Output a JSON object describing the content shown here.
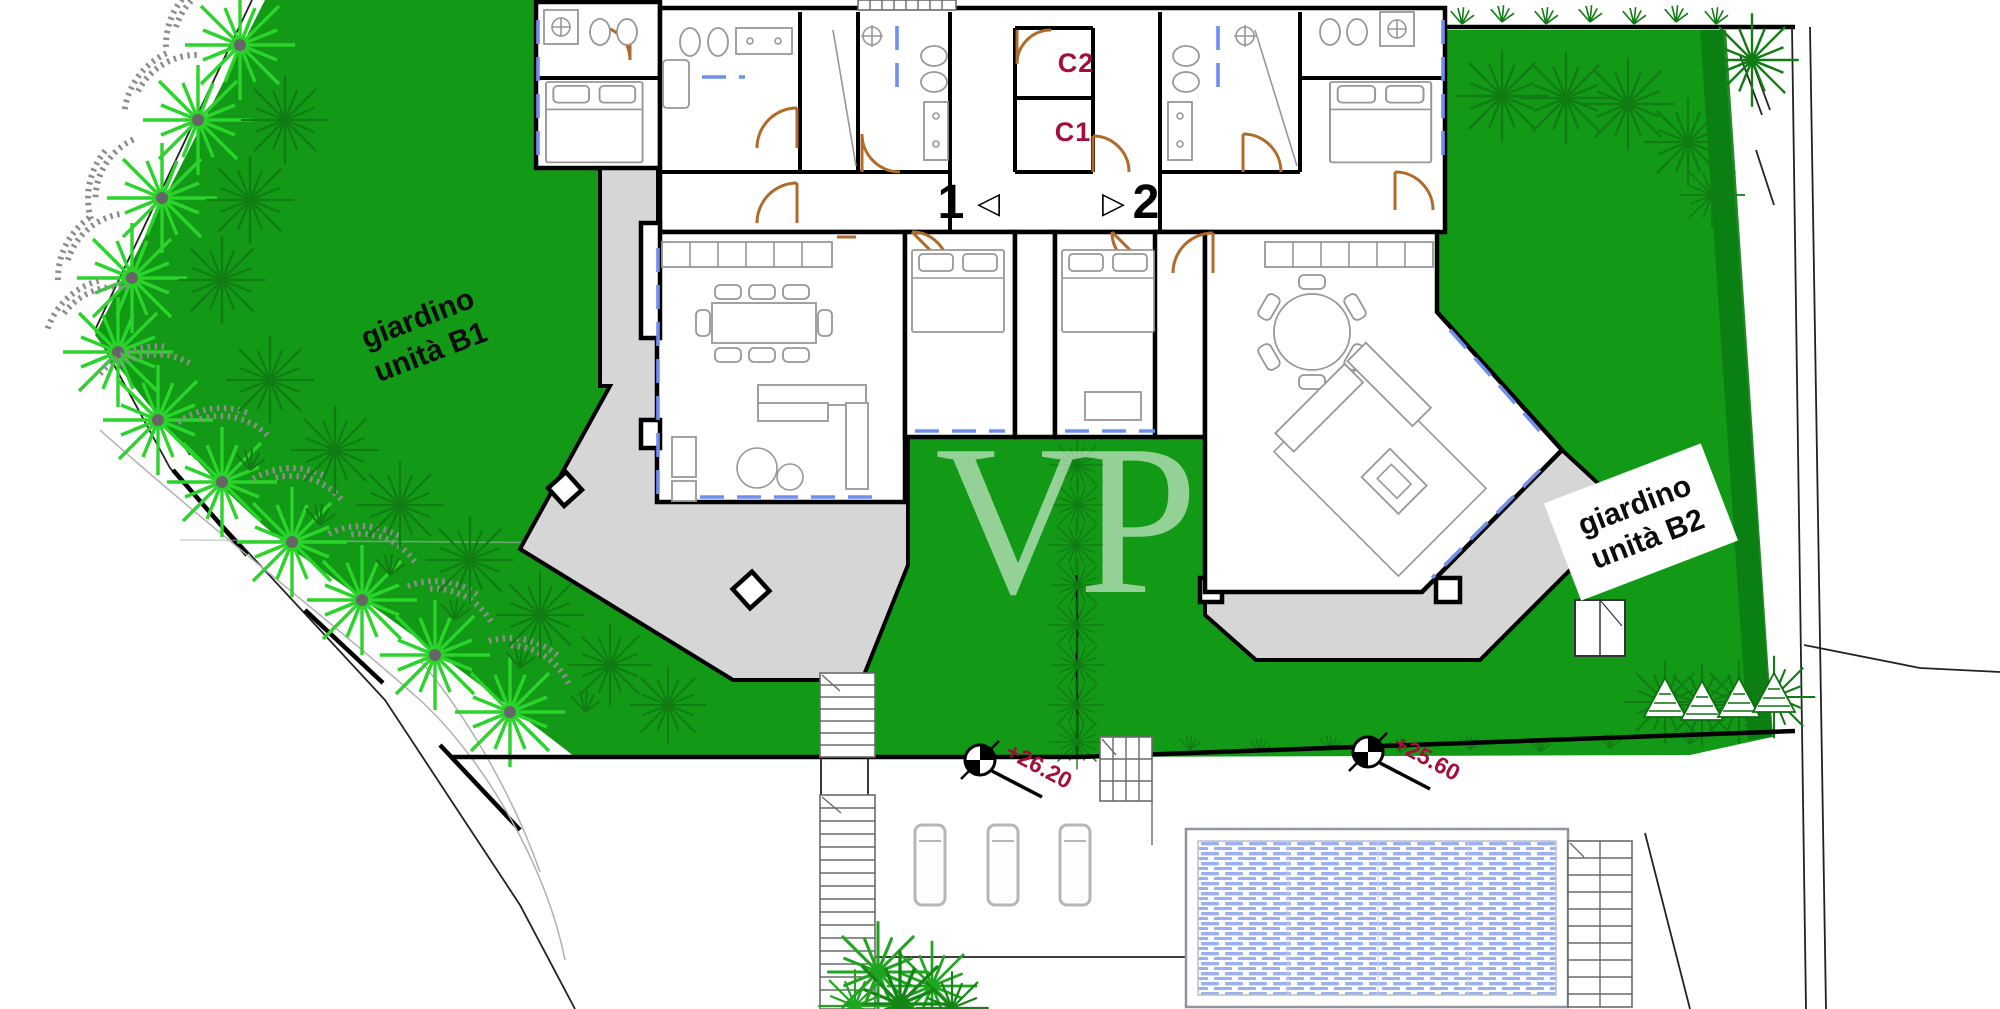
{
  "plan": {
    "watermark": "VP",
    "gardens": {
      "b1": {
        "line1": "giardino",
        "line2": "unità B1"
      },
      "b2": {
        "line1": "giardino",
        "line2": "unità B2"
      }
    },
    "storage": {
      "c1": "C1",
      "c2": "C2"
    },
    "entrances": {
      "unit1": {
        "number": "1",
        "arrow": "◁"
      },
      "unit2": {
        "number": "2",
        "arrow": "▷"
      }
    },
    "elevations": {
      "terrace": "+26.20",
      "pool": "+25.60"
    },
    "colors": {
      "lawn": "#129a17",
      "lawn_dark": "#0b7d12",
      "tree_bright": "#2ad42a",
      "shrub_dark": "#117c14",
      "speckle_gray": "#8d8d8d",
      "terrace_gray": "#d6d6d6",
      "wall_black": "#000000",
      "door_arc": "#b06a2a",
      "window_blue": "#6f8fee",
      "pool_tile": "#8aa3ec",
      "furniture_gray": "#979797",
      "label_red": "#a30f3a"
    }
  }
}
